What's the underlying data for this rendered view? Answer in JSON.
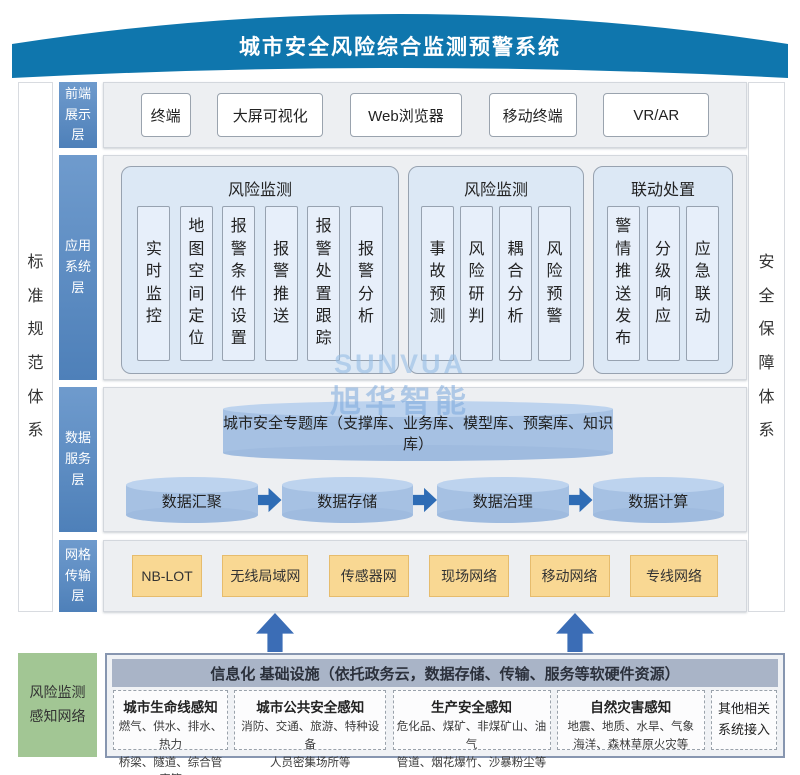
{
  "banner": {
    "title": "城市安全风险综合监测预警系统"
  },
  "side_bars": {
    "left": "标准规范体系",
    "right": "安全保障体系"
  },
  "watermark": {
    "latin": "SUNVUA",
    "cjk": "旭华智能"
  },
  "layers": {
    "front": {
      "label": "前端展示层",
      "items": [
        "终端",
        "大屏可视化",
        "Web浏览器",
        "移动终端",
        "VR/AR"
      ]
    },
    "app": {
      "label": "应用系统层",
      "groups": [
        {
          "title": "风险监测",
          "items": [
            "实时监控",
            "地图空间定位",
            "报警条件设置",
            "报警推送",
            "报警处置跟踪",
            "报警分析"
          ]
        },
        {
          "title": "风险监测",
          "items": [
            "事故预测",
            "风险研判",
            "耦合分析",
            "风险预警"
          ]
        },
        {
          "title": "联动处置",
          "items": [
            "警情推送发布",
            "分级响应",
            "应急联动"
          ]
        }
      ]
    },
    "data": {
      "label": "数据服务层",
      "repository": "城市安全专题库（支撑库、业务库、模型库、预案库、知识库）",
      "pipeline": [
        "数据汇聚",
        "数据存储",
        "数据治理",
        "数据计算"
      ]
    },
    "network": {
      "label": "网格传输层",
      "items": [
        "NB-LOT",
        "无线局域网",
        "传感器网",
        "现场网络",
        "移动网络",
        "专线网络"
      ]
    }
  },
  "perception": {
    "side_label_lines": [
      "风险监测",
      "感知网络"
    ],
    "infra_header": "信息化 基础设施（依托政务云，数据存储、传输、服务等软硬件资源）",
    "sense_boxes": [
      {
        "title": "城市生命线感知",
        "lines": [
          "燃气、供水、排水、热力",
          "桥梁、隧道、综合管廊等"
        ]
      },
      {
        "title": "城市公共安全感知",
        "lines": [
          "消防、交通、旅游、特种设备",
          "人员密集场所等"
        ]
      },
      {
        "title": "生产安全感知",
        "lines": [
          "危化品、煤矿、非煤矿山、油气",
          "管道、烟花爆竹、沙暴粉尘等"
        ]
      },
      {
        "title": "自然灾害感知",
        "lines": [
          "地震、地质、水旱、气象",
          "海洋、森林草原火灾等"
        ]
      },
      {
        "title": "其他相关系统接入"
      }
    ]
  },
  "colors": {
    "banner_blue": "#0f76ad",
    "label_blue": "#5b8cc2",
    "layer_bg": "#edeff2",
    "group_blue": "#dce8f5",
    "cylinder_blue": "#a6c1e3",
    "flow_arrow_blue": "#2e6cb5",
    "network_orange": "#f9d893",
    "perception_green": "#a2c694",
    "infra_gray": "#a9b4c7"
  }
}
